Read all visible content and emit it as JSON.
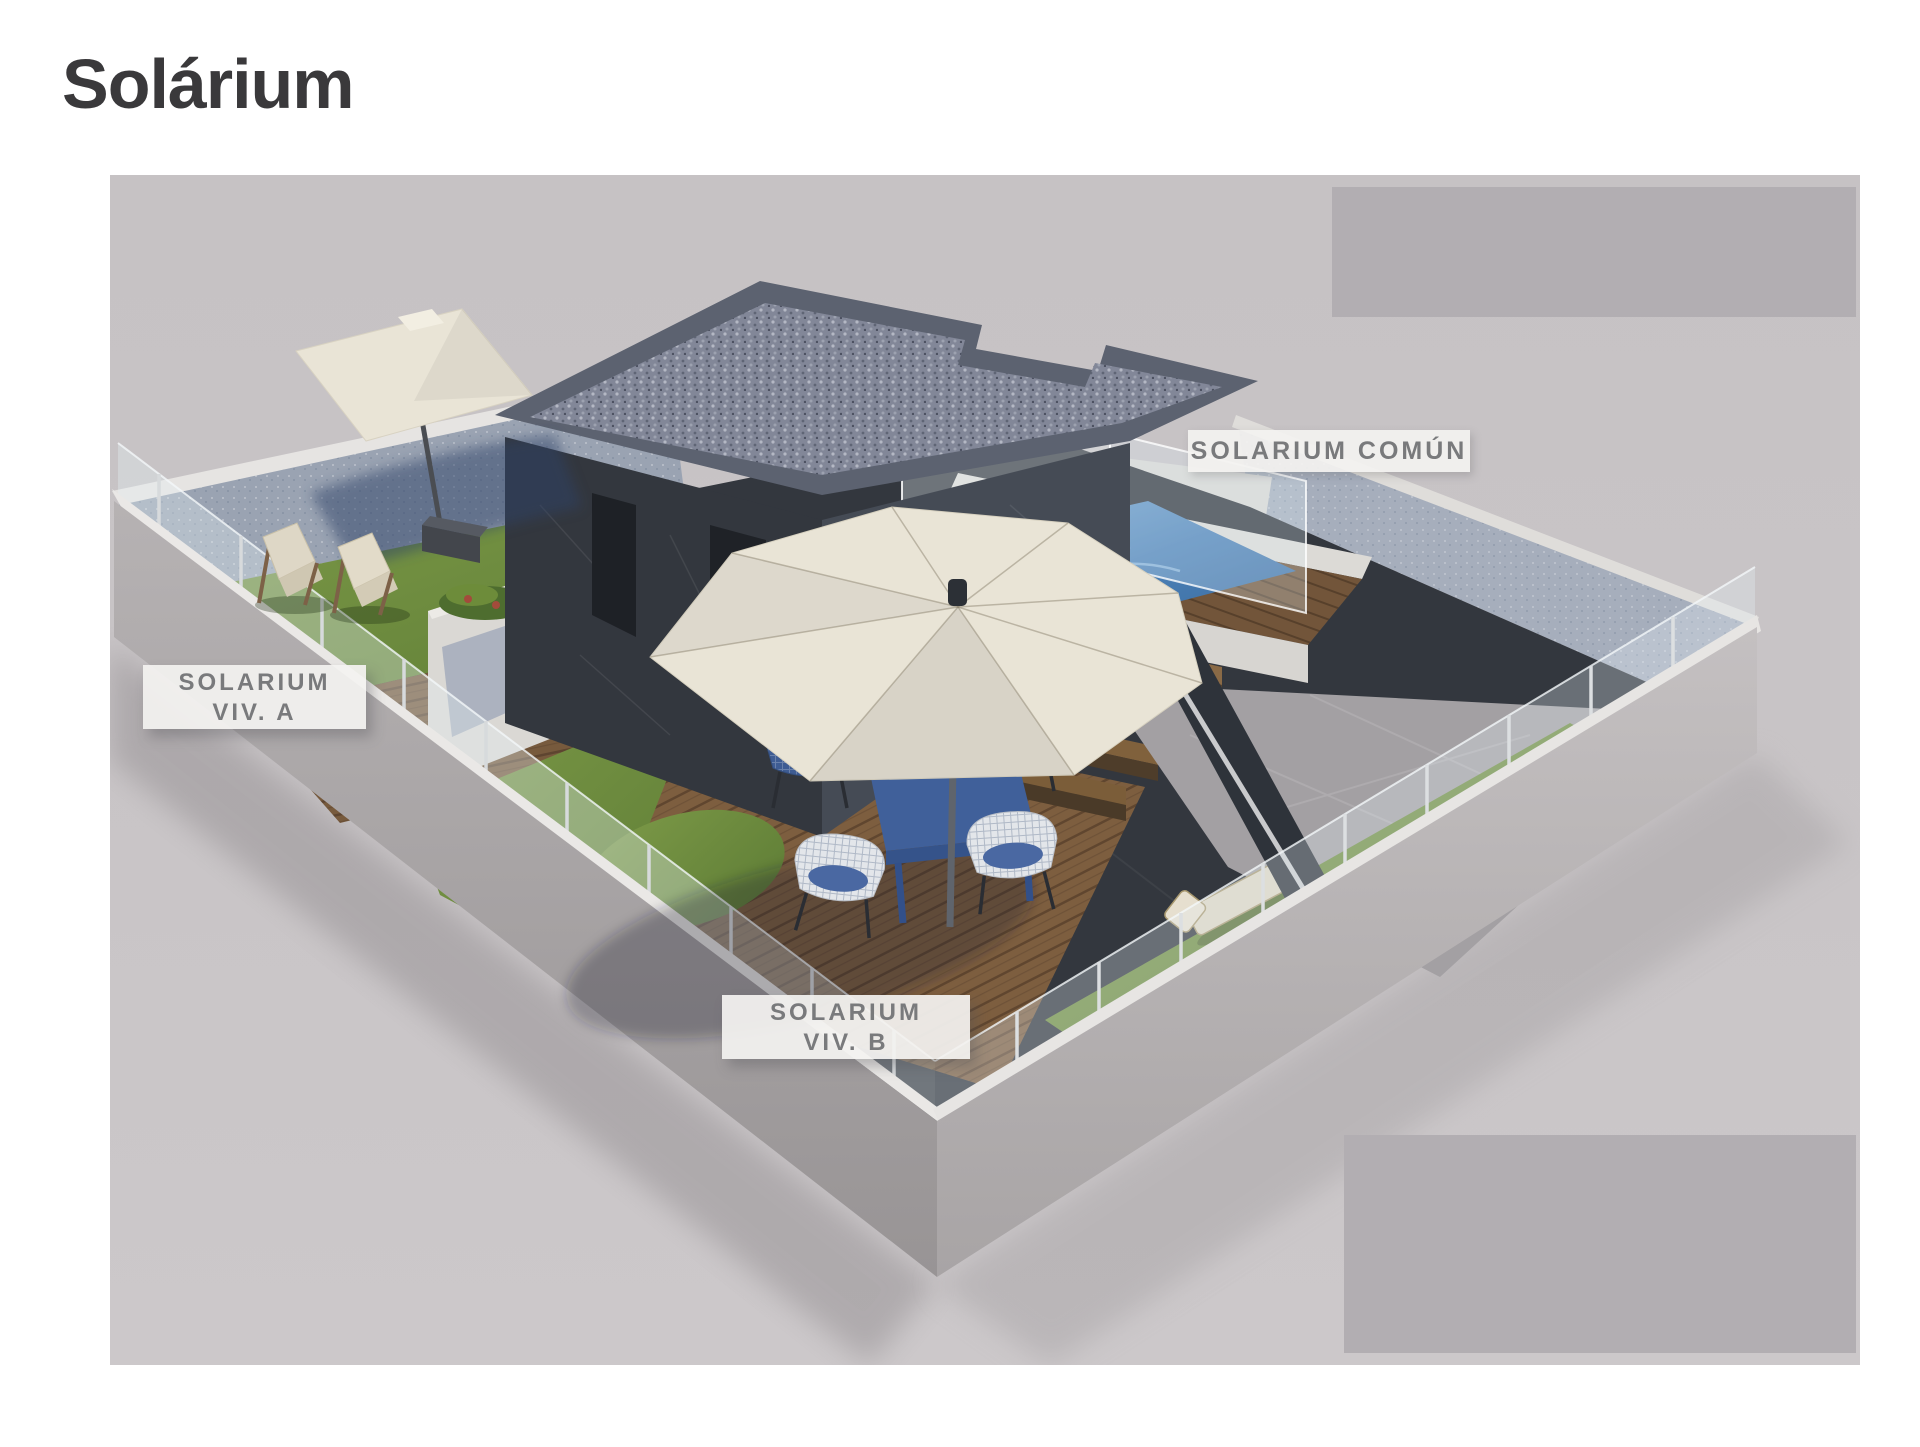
{
  "page": {
    "title": "Solárium"
  },
  "scene": {
    "labels": {
      "comun": {
        "text": "SOLARIUM COMÚN"
      },
      "viv_a": {
        "line1": "SOLARIUM",
        "line2": "VIV. A"
      },
      "viv_b": {
        "line1": "SOLARIUM",
        "line2": "VIV. B"
      }
    }
  },
  "colors": {
    "title_text": "#3a393b",
    "label_text": "#797a7c",
    "label_bg": "#f3f2f0",
    "photo_bg": "#c7c3c5",
    "overlay_gray": "#b2aeb2",
    "charcoal": "#33373e",
    "concrete": "#b5b1b2",
    "cap_white": "#eae8e6",
    "wall_blue_gray": "#9aa3b2",
    "grass_green": "#74903f",
    "wood_brown": "#7a5b3c",
    "pool_blue": "#4d82b8",
    "umbrella_cream": "#e9e4d6",
    "furniture_navy": "#3f5d94",
    "stone_gray": "#a3a0a3"
  }
}
